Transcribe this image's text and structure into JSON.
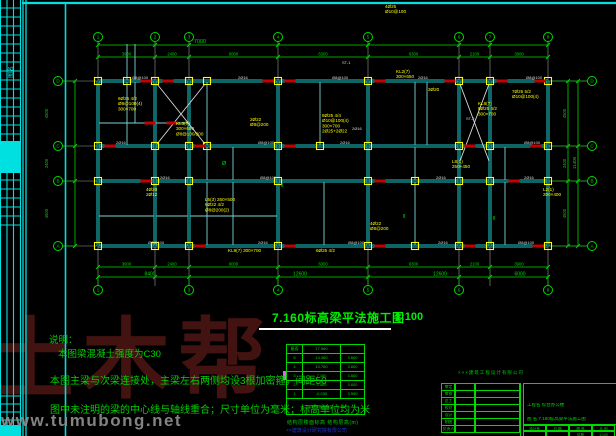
{
  "watermark": {
    "brand": "土木帮",
    "site": "www.tumubong.net"
  },
  "drawing_title": {
    "text": "7.160标高梁平法施工图",
    "scale": "1:100"
  },
  "notes": {
    "heading": "说明：",
    "lines": [
      "本图梁混凝土强度为C30",
      "本图主梁与次梁连接处，主梁左右两侧均设3根加密箍，间距50",
      "图中未注明的梁的中心线与轴线重合；尺寸单位为毫米；标高单位均为米"
    ]
  },
  "floor_table": {
    "rows": [
      [
        "屋面",
        "17.960",
        ""
      ],
      [
        "5",
        "14.360",
        "3.600"
      ],
      [
        "4",
        "10.760",
        "3.600"
      ],
      [
        "3",
        "7.160",
        "3.600"
      ],
      [
        "2",
        "3.560",
        "3.600"
      ],
      [
        "1",
        "-0.030",
        "3.590"
      ]
    ],
    "footer": "上部结构嵌固部位：-0.030",
    "caption": "结构层楼面标高 结构层高(m)",
    "company": "××建筑设计研究院有限公司"
  },
  "title_block": {
    "stamp": "×××建筑工程设计有限公司",
    "left_rows": [
      "审定",
      "审核",
      "总工",
      "校对",
      "设计",
      "制图",
      "负责人"
    ],
    "project_label": "工程名",
    "project_value": "综合办公楼",
    "drawing_label": "图 名",
    "drawing_value": "7.160标高梁平法施工图",
    "footer_cols": [
      "设计号",
      "日 期",
      "图 号",
      "比 例"
    ],
    "footer_vals": [
      "",
      "",
      "结施",
      "1:100"
    ]
  },
  "colors": {
    "cyan": "#00e0e0",
    "green": "#00d800",
    "yellow": "#ffff00",
    "red": "#c40000",
    "white": "#d8d8d8",
    "axis": "#9b9b9b",
    "beam": "#1fc9c9",
    "beam_core": "#00282a",
    "magenta": "#ff4fff"
  },
  "side_strip": {
    "cols": [
      0.5,
      7,
      13.5,
      20.5
    ],
    "row_zones": [
      [
        8,
        134,
        9
      ],
      [
        180,
        225,
        9
      ],
      [
        396,
        436,
        8
      ]
    ],
    "filled": [
      [
        1,
        141,
        19,
        32
      ],
      [
        1,
        425,
        19,
        11
      ]
    ],
    "vtext": {
      "x": 13,
      "y": 72,
      "s": "图名"
    },
    "frame_double_x": [
      23,
      26
    ],
    "sheet_border_x": 65.5,
    "sheet_top_y": 3
  },
  "plan": {
    "v_axes": [
      98,
      155,
      189,
      278,
      368,
      459,
      490,
      548
    ],
    "h_axes": [
      81,
      146,
      181,
      246
    ],
    "axis_numbers": [
      "1",
      "2",
      "3",
      "4",
      "5",
      "6",
      "7",
      "8"
    ],
    "axis_letters": [
      "D",
      "C",
      "B",
      "A"
    ],
    "bottom_bubble_idx": [
      0,
      2,
      3,
      4,
      5,
      7
    ],
    "bubble_rows": {
      "top_y": 37,
      "bottom_y": 290,
      "left_x": 58,
      "right_x": 592
    },
    "h_beams_main": [
      [
        81,
        98,
        548
      ],
      [
        146,
        98,
        548
      ],
      [
        181,
        98,
        548
      ],
      [
        246,
        98,
        548
      ]
    ],
    "v_beams_main": [
      [
        98,
        81,
        246
      ],
      [
        155,
        81,
        246
      ],
      [
        189,
        81,
        246
      ],
      [
        278,
        81,
        246
      ],
      [
        368,
        81,
        246
      ],
      [
        459,
        81,
        246
      ],
      [
        490,
        81,
        246
      ],
      [
        548,
        81,
        246
      ]
    ],
    "h_beams_sec": [
      [
        123,
        98,
        189
      ],
      [
        216,
        98,
        278
      ]
    ],
    "v_beams_sec": [
      [
        127,
        44,
        146
      ],
      [
        135,
        44,
        123
      ],
      [
        207,
        81,
        246
      ],
      [
        233,
        146,
        246
      ],
      [
        320,
        81,
        146
      ],
      [
        324,
        181,
        246
      ],
      [
        415,
        81,
        246
      ],
      [
        427,
        81,
        146
      ],
      [
        505,
        146,
        246
      ]
    ],
    "extra_columns": [
      [
        127,
        81
      ],
      [
        207,
        81
      ],
      [
        207,
        146
      ],
      [
        320,
        146
      ],
      [
        415,
        181
      ],
      [
        415,
        246
      ]
    ],
    "red_marks": [
      [
        146,
        81
      ],
      [
        168,
        81
      ],
      [
        268,
        81
      ],
      [
        290,
        81
      ],
      [
        380,
        81
      ],
      [
        450,
        81
      ],
      [
        502,
        81
      ],
      [
        540,
        81
      ],
      [
        150,
        123
      ],
      [
        172,
        123
      ],
      [
        110,
        146
      ],
      [
        200,
        146
      ],
      [
        290,
        146
      ],
      [
        470,
        146
      ],
      [
        536,
        146
      ],
      [
        146,
        181
      ],
      [
        380,
        181
      ],
      [
        514,
        181
      ],
      [
        200,
        246
      ],
      [
        290,
        246
      ],
      [
        380,
        246
      ],
      [
        470,
        246
      ],
      [
        538,
        246
      ]
    ],
    "braces": [
      [
        157,
        84,
        205,
        144
      ],
      [
        205,
        84,
        157,
        144
      ],
      [
        460,
        84,
        489,
        161
      ],
      [
        489,
        84,
        460,
        161
      ]
    ],
    "magenta_marker": [
      283,
      371,
      4,
      9
    ],
    "annotations": [
      {
        "x": 118,
        "y": 95,
        "lines": [
          "6Ø25 4/2",
          "Ø8@100(4)",
          "300×700"
        ]
      },
      {
        "x": 176,
        "y": 120,
        "lines": [
          "KL3(7)",
          "300×600",
          "Ø8@100/200"
        ]
      },
      {
        "x": 250,
        "y": 116,
        "lines": [
          "2Ø22",
          "Ø8@200"
        ]
      },
      {
        "x": 322,
        "y": 112,
        "lines": [
          "8Ø25 4/4",
          "Ø10@100(4)",
          "300×700",
          "2Ø25+2Ø22"
        ]
      },
      {
        "x": 205,
        "y": 196,
        "lines": [
          "L5(3) 250×500",
          "6Ø22 4/2",
          "Ø8@200(2)"
        ]
      },
      {
        "x": 146,
        "y": 186,
        "lines": [
          "4Ø20",
          "2Ø12"
        ]
      },
      {
        "x": 478,
        "y": 100,
        "lines": [
          "KL6(7)",
          "6Ø25 4/2",
          "300×700"
        ]
      },
      {
        "x": 512,
        "y": 88,
        "lines": [
          "7Ø25 5/2",
          "Ø10@100(4)"
        ]
      },
      {
        "x": 452,
        "y": 158,
        "lines": [
          "L8(1)",
          "250×450"
        ]
      },
      {
        "x": 370,
        "y": 220,
        "lines": [
          "4Ø22",
          "Ø8@200"
        ]
      },
      {
        "x": 228,
        "y": 247,
        "lines": [
          "KL9(7) 300×700"
        ]
      },
      {
        "x": 316,
        "y": 247,
        "lines": [
          "6Ø25 4/2"
        ]
      },
      {
        "x": 543,
        "y": 186,
        "lines": [
          "L2(1)",
          "200×400"
        ]
      },
      {
        "x": 396,
        "y": 68,
        "lines": [
          "KL2(7)",
          "300×650"
        ]
      },
      {
        "x": 428,
        "y": 86,
        "lines": [
          "3Ø20"
        ]
      },
      {
        "x": 385,
        "y": 3,
        "lines": [
          "4Ø25",
          "Ø10@100"
        ]
      }
    ],
    "white_labels": [
      {
        "x": 132,
        "y": 79,
        "s": "Ø8@100"
      },
      {
        "x": 238,
        "y": 79,
        "s": "2Ø16"
      },
      {
        "x": 332,
        "y": 79,
        "s": "Ø8@100"
      },
      {
        "x": 418,
        "y": 79,
        "s": "2Ø16"
      },
      {
        "x": 526,
        "y": 79,
        "s": "Ø8@100"
      },
      {
        "x": 116,
        "y": 144,
        "s": "2Ø16"
      },
      {
        "x": 258,
        "y": 144,
        "s": "Ø8@100"
      },
      {
        "x": 340,
        "y": 144,
        "s": "2Ø16"
      },
      {
        "x": 524,
        "y": 144,
        "s": "Ø8@100"
      },
      {
        "x": 160,
        "y": 179,
        "s": "2Ø16"
      },
      {
        "x": 260,
        "y": 179,
        "s": "Ø8@100"
      },
      {
        "x": 436,
        "y": 179,
        "s": "2Ø16"
      },
      {
        "x": 524,
        "y": 179,
        "s": "2Ø16"
      },
      {
        "x": 148,
        "y": 244,
        "s": "Ø8@100"
      },
      {
        "x": 258,
        "y": 244,
        "s": "2Ø16"
      },
      {
        "x": 348,
        "y": 244,
        "s": "Ø8@100"
      },
      {
        "x": 438,
        "y": 244,
        "s": "2Ø16"
      },
      {
        "x": 518,
        "y": 244,
        "s": "Ø8@100"
      },
      {
        "x": 342,
        "y": 64,
        "s": "ST-1"
      },
      {
        "x": 352,
        "y": 130,
        "s": "2Ø16"
      },
      {
        "x": 466,
        "y": 120,
        "s": "ST-2"
      }
    ],
    "green_glyphs": [
      {
        "x": 282,
        "y": 187,
        "s": "¢"
      },
      {
        "x": 404,
        "y": 218,
        "s": "¢"
      },
      {
        "x": 494,
        "y": 220,
        "s": "¢"
      },
      {
        "x": 224,
        "y": 165,
        "s": "Ø"
      }
    ],
    "dims": {
      "top_line1_y": 45,
      "top_line2_y": 57,
      "bottom_line1_y": 267,
      "bottom_line2_y": 277,
      "left_line_x": 75,
      "right_line1_x": 568,
      "right_line2_x": 578,
      "top_single": {
        "x": 200,
        "s": "7000"
      },
      "bay_dims": [
        "3900",
        "2400",
        "6000",
        "6300",
        "6300",
        "2100",
        "3900"
      ],
      "group_dims": [
        {
          "x": 150,
          "s": "8400"
        },
        {
          "x": 300,
          "s": "12600"
        },
        {
          "x": 440,
          "s": "12600"
        },
        {
          "x": 520,
          "s": "6000"
        }
      ],
      "left_dims": [
        "4500",
        "2400",
        "4500"
      ],
      "right_dims": [
        "4500",
        "2400",
        "4500"
      ],
      "right_total": "11400"
    }
  }
}
